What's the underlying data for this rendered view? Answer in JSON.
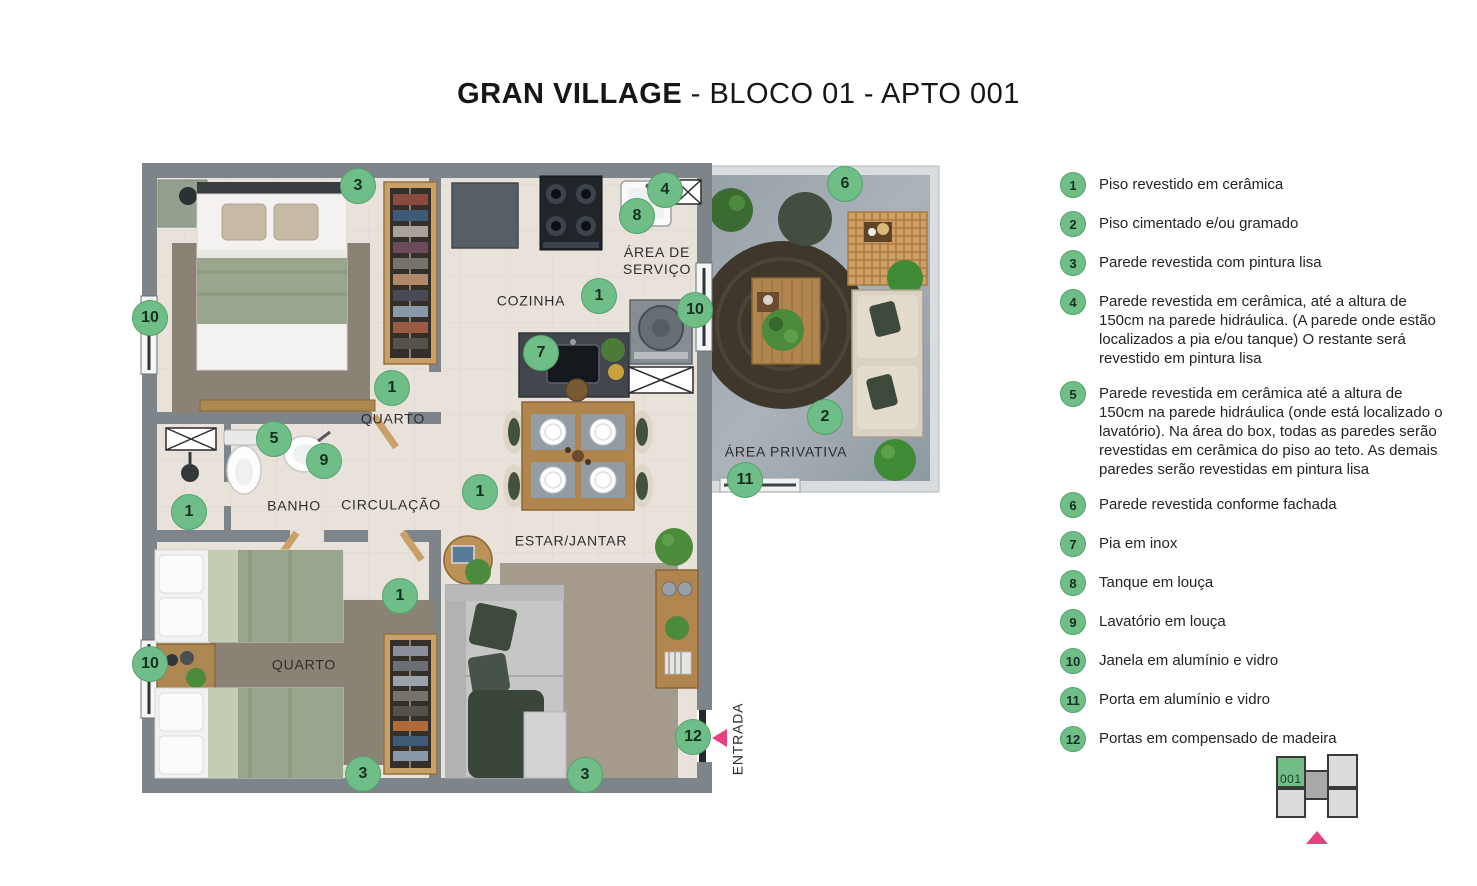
{
  "title": {
    "brand": "GRAN VILLAGE",
    "rest": " - BLOCO 01 - APTO 001"
  },
  "colors": {
    "marker_green": "#6fbe87",
    "entrance_pink": "#e8417f",
    "wall_gray": "#7d848a",
    "floor_beige": "#e9e2db",
    "patio_concrete": "#a0aab1",
    "minimap_green": "#72bd85"
  },
  "plan": {
    "room_labels": [
      {
        "label": "COZINHA"
      },
      {
        "label": "ÁREA DE SERVIÇO"
      },
      {
        "label": "QUARTO"
      },
      {
        "label": "ÁREA PRIVATIVA"
      },
      {
        "label": "BANHO"
      },
      {
        "label": "CIRCULAÇÃO"
      },
      {
        "label": "ESTAR/JANTAR"
      },
      {
        "label": "QUARTO"
      },
      {
        "label": "ENTRADA"
      }
    ],
    "markers": [
      {
        "n": "3"
      },
      {
        "n": "4"
      },
      {
        "n": "8"
      },
      {
        "n": "6"
      },
      {
        "n": "1"
      },
      {
        "n": "10"
      },
      {
        "n": "10"
      },
      {
        "n": "7"
      },
      {
        "n": "1"
      },
      {
        "n": "2"
      },
      {
        "n": "5"
      },
      {
        "n": "9"
      },
      {
        "n": "11"
      },
      {
        "n": "1"
      },
      {
        "n": "1"
      },
      {
        "n": "1"
      },
      {
        "n": "10"
      },
      {
        "n": "12"
      },
      {
        "n": "3"
      },
      {
        "n": "3"
      }
    ]
  },
  "legend": {
    "items": [
      {
        "num": "1",
        "text": "Piso revestido em cerâmica"
      },
      {
        "num": "2",
        "text": "Piso cimentado e/ou gramado"
      },
      {
        "num": "3",
        "text": "Parede revestida com pintura lisa"
      },
      {
        "num": "4",
        "text": "Parede revestida em cerâmica, até a altura de 150cm na parede hidráulica. (A parede onde estão localizados a pia e/ou tanque) O restante será revestido em pintura lisa"
      },
      {
        "num": "5",
        "text": "Parede revestida em cerâmica até a altura de 150cm na parede hidráulica (onde está localizado o lavatório). Na área do box, todas as paredes serão revestidas em cerâmica do piso ao teto. As demais paredes serão revestidas em pintura lisa"
      },
      {
        "num": "6",
        "text": "Parede revestida conforme fachada"
      },
      {
        "num": "7",
        "text": "Pia em inox"
      },
      {
        "num": "8",
        "text": "Tanque em louça"
      },
      {
        "num": "9",
        "text": "Lavatório em louça"
      },
      {
        "num": "10",
        "text": "Janela em alumínio e vidro"
      },
      {
        "num": "11",
        "text": "Porta em alumínio e vidro"
      },
      {
        "num": "12",
        "text": "Portas em compensado de madeira"
      }
    ]
  },
  "minimap": {
    "unit": "001"
  }
}
